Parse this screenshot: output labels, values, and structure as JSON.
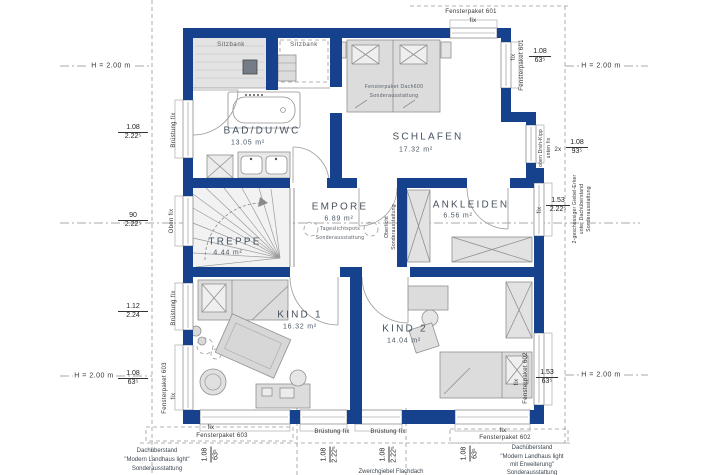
{
  "colors": {
    "wall": "#16418c",
    "furniture_fill": "#dcdcdc",
    "furniture_stroke": "#909090",
    "dash_line": "#9a9a9a",
    "label_text": "#46525e",
    "dim_text": "#222222"
  },
  "rooms": {
    "sitzbank_left": {
      "label": "Sitzbank"
    },
    "sitzbank_right": {
      "label": "Sitzbank"
    },
    "bad": {
      "name": "BAD/DU/WC",
      "area": "13.05 m²"
    },
    "schlafen": {
      "name": "SCHLAFEN",
      "area": "17.32 m²"
    },
    "empore": {
      "name": "EMPORE",
      "area": "6.89 m²",
      "note1": "Tageslichtspots",
      "note2": "Sonderausstattung"
    },
    "ankleiden": {
      "name": "ANKLEIDEN",
      "area": "6.56 m²"
    },
    "treppe": {
      "name": "TREPPE",
      "area": "4.44 m²"
    },
    "kind1": {
      "name": "KIND 1",
      "area": "16.32 m²"
    },
    "kind2": {
      "name": "KIND 2",
      "area": "14.04 m²"
    }
  },
  "notes": {
    "bed": {
      "l1": "Fensterpaket Dach600",
      "l2": "Sonderausstattung"
    },
    "oberlicht": {
      "l1": "Oberlicht",
      "l2": "Sonderausstattung"
    },
    "giebel": {
      "l1": "2-geschossiger Giebel-Erker",
      "l2": "unter Dachüberstand",
      "l3": "Sonderausstattung"
    },
    "overhang_left": {
      "l1": "Dachüberstand",
      "l2": "\"Modern Landhaus light\"",
      "l3": "Sonderausstattung"
    },
    "overhang_right": {
      "l1": "Dachüberstand",
      "l2": "\"Modern Landhaus light",
      "l3": "mit Erweiterung\"",
      "l4": "Sonderausstattung"
    },
    "flachdach": "Zwerchgiebel Flachdach"
  },
  "heights": {
    "top_left": "H = 2.00 m",
    "top_right": "H = 2.00 m",
    "bottom_left": "H = 2.00 m",
    "bottom_right": "H = 2.00 m"
  },
  "windows": {
    "left1": {
      "num": "1.08",
      "den": "2.22⁵",
      "label": "Brüstung fix"
    },
    "left2": {
      "num": "90",
      "den": "2.22⁵",
      "label": "Oben fix"
    },
    "left3": {
      "num": "1.12",
      "den": "2.24",
      "label": "Brüstung fix"
    },
    "left4": {
      "num": "1.08",
      "den": "63⁵",
      "label1": "Fensterpaket 603",
      "label2": "fix"
    },
    "top1": {
      "label1": "Fensterpaket 601",
      "label2": "fix"
    },
    "right1": {
      "num": "1.08",
      "den": "63⁵",
      "label1": "fix",
      "label2": "Fensterpaket 601"
    },
    "right2": {
      "prefix": "2x",
      "num": "1.08",
      "den": "93⁵",
      "label1": "oben Dreh-Kipp",
      "label2": "unten fix"
    },
    "right3": {
      "num": "1.53",
      "den": "2.22⁵",
      "label": "fix"
    },
    "right4": {
      "num": "1.53",
      "den": "63⁵",
      "label1": "fix",
      "label2": "Fensterpaket 602"
    },
    "bottom1": {
      "label1": "fix",
      "label2": "Fensterpaket 603",
      "num": "1.08",
      "den": "63⁵"
    },
    "bottom2": {
      "label": "Brüstung fix",
      "num": "1.08",
      "den": "2.22⁵"
    },
    "bottom3": {
      "label": "Brüstung fix",
      "num": "1.08",
      "den": "2.22⁵"
    },
    "bottom4": {
      "label1": "fix",
      "label2": "Fensterpaket 602",
      "num": "1.08",
      "den": "63⁵"
    }
  }
}
